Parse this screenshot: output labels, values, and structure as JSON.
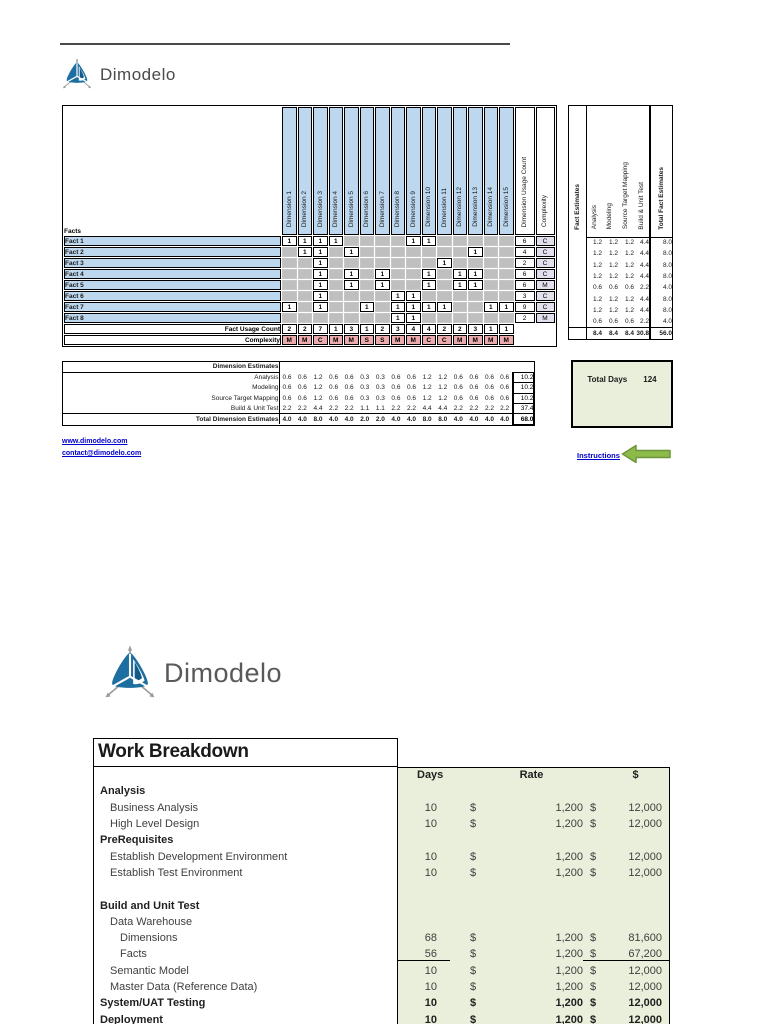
{
  "page1": {
    "brand": "Dimodelo",
    "matrix": {
      "facts_header": "Facts",
      "dimensions": [
        "Dimension 1",
        "Dimension 2",
        "Dimension 3",
        "Dimension 4",
        "Dimension 5",
        "Dimension 6",
        "Dimension 7",
        "Dimension 8",
        "Dimension 9",
        "Dimension 10",
        "Dimension 11",
        "Dimension 12",
        "Dimension 13",
        "Dimension 14",
        "Dimension 15"
      ],
      "usage_count_header": "Dimension Usage Count",
      "complexity_header": "Complexity",
      "facts": [
        {
          "label": "Fact 1",
          "cells": [
            "1",
            "1",
            "1",
            "1",
            "",
            "",
            "",
            "",
            "1",
            "1",
            "",
            "",
            "",
            "",
            ""
          ],
          "usage": "6",
          "complexity": "C"
        },
        {
          "label": "Fact 2",
          "cells": [
            "",
            "1",
            "1",
            "",
            "1",
            "",
            "",
            "",
            "",
            "",
            "",
            "",
            "1",
            "",
            ""
          ],
          "usage": "4",
          "complexity": "C"
        },
        {
          "label": "Fact 3",
          "cells": [
            "",
            "",
            "1",
            "",
            "",
            "",
            "",
            "",
            "",
            "",
            "1",
            "",
            "",
            "",
            ""
          ],
          "usage": "2",
          "complexity": "C"
        },
        {
          "label": "Fact 4",
          "cells": [
            "",
            "",
            "1",
            "",
            "1",
            "",
            "1",
            "",
            "",
            "1",
            "",
            "1",
            "1",
            "",
            ""
          ],
          "usage": "6",
          "complexity": "C"
        },
        {
          "label": "Fact 5",
          "cells": [
            "",
            "",
            "1",
            "",
            "1",
            "",
            "1",
            "",
            "",
            "1",
            "",
            "1",
            "1",
            "",
            ""
          ],
          "usage": "6",
          "complexity": "M"
        },
        {
          "label": "Fact 6",
          "cells": [
            "",
            "",
            "1",
            "",
            "",
            "",
            "",
            "1",
            "1",
            "",
            "",
            "",
            "",
            "",
            ""
          ],
          "usage": "3",
          "complexity": "C"
        },
        {
          "label": "Fact 7",
          "cells": [
            "1",
            "",
            "1",
            "",
            "",
            "1",
            "",
            "1",
            "1",
            "1",
            "1",
            "",
            "",
            "1",
            "1"
          ],
          "usage": "9",
          "complexity": "C"
        },
        {
          "label": "Fact 8",
          "cells": [
            "",
            "",
            "",
            "",
            "",
            "",
            "",
            "1",
            "1",
            "",
            "",
            "",
            "",
            "",
            ""
          ],
          "usage": "2",
          "complexity": "M"
        }
      ],
      "fact_usage_label": "Fact Usage Count",
      "fact_usage_counts": [
        "2",
        "2",
        "7",
        "1",
        "3",
        "1",
        "2",
        "3",
        "4",
        "4",
        "2",
        "2",
        "3",
        "1",
        "1"
      ],
      "complexity_label": "Complexity",
      "dimension_complexity": [
        "M",
        "M",
        "C",
        "M",
        "M",
        "S",
        "S",
        "M",
        "M",
        "C",
        "C",
        "M",
        "M",
        "M",
        "M"
      ]
    },
    "fact_estimates": {
      "header": "Fact Estimates",
      "columns": [
        "Analysis",
        "Modeling",
        "Source Target Mapping",
        "Build & Unit Test"
      ],
      "total_header": "Total Fact Estimates",
      "rows": [
        [
          "1.2",
          "1.2",
          "1.2",
          "4.4",
          "8.0"
        ],
        [
          "1.2",
          "1.2",
          "1.2",
          "4.4",
          "8.0"
        ],
        [
          "1.2",
          "1.2",
          "1.2",
          "4.4",
          "8.0"
        ],
        [
          "1.2",
          "1.2",
          "1.2",
          "4.4",
          "8.0"
        ],
        [
          "0.6",
          "0.6",
          "0.6",
          "2.2",
          "4.0"
        ],
        [
          "1.2",
          "1.2",
          "1.2",
          "4.4",
          "8.0"
        ],
        [
          "1.2",
          "1.2",
          "1.2",
          "4.4",
          "8.0"
        ],
        [
          "0.6",
          "0.6",
          "0.6",
          "2.2",
          "4.0"
        ]
      ],
      "totals": [
        "8.4",
        "8.4",
        "8.4",
        "30.8",
        "56.0"
      ]
    },
    "dimension_estimates": {
      "header": "Dimension Estimates",
      "rows": [
        {
          "label": "Analysis",
          "values": [
            "0.6",
            "0.6",
            "1.2",
            "0.6",
            "0.6",
            "0.3",
            "0.3",
            "0.6",
            "0.6",
            "1.2",
            "1.2",
            "0.6",
            "0.6",
            "0.6",
            "0.6"
          ],
          "total": "10.2"
        },
        {
          "label": "Modeling",
          "values": [
            "0.6",
            "0.6",
            "1.2",
            "0.6",
            "0.6",
            "0.3",
            "0.3",
            "0.6",
            "0.6",
            "1.2",
            "1.2",
            "0.6",
            "0.6",
            "0.6",
            "0.6"
          ],
          "total": "10.2"
        },
        {
          "label": "Source Target Mapping",
          "values": [
            "0.6",
            "0.6",
            "1.2",
            "0.6",
            "0.6",
            "0.3",
            "0.3",
            "0.6",
            "0.6",
            "1.2",
            "1.2",
            "0.6",
            "0.6",
            "0.6",
            "0.6"
          ],
          "total": "10.2"
        },
        {
          "label": "Build & Unit Test",
          "values": [
            "2.2",
            "2.2",
            "4.4",
            "2.2",
            "2.2",
            "1.1",
            "1.1",
            "2.2",
            "2.2",
            "4.4",
            "4.4",
            "2.2",
            "2.2",
            "2.2",
            "2.2"
          ],
          "total": "37.4"
        },
        {
          "label": "Total Dimension Estimates",
          "values": [
            "4.0",
            "4.0",
            "8.0",
            "4.0",
            "4.0",
            "2.0",
            "2.0",
            "4.0",
            "4.0",
            "8.0",
            "8.0",
            "4.0",
            "4.0",
            "4.0",
            "4.0"
          ],
          "total": "68.0"
        }
      ]
    },
    "total_days": {
      "label": "Total Days",
      "value": "124"
    },
    "links": {
      "website": "www.dimodelo.com",
      "email": "contact@dimodelo.com"
    },
    "instructions": "Instructions",
    "colors": {
      "cell_blue": "#bdd7ee",
      "cell_gray": "#bfbfbf",
      "complexity_lavender": "#e4dfec",
      "complexity_pink": "#ecabad",
      "panel_green": "#e9efdb",
      "link_blue": "#0000cc",
      "arrow_green": "#8dbb4a"
    }
  },
  "page2": {
    "brand": "Dimodelo",
    "work_breakdown": {
      "title": "Work Breakdown",
      "columns": {
        "days": "Days",
        "rate": "Rate",
        "amount": "$"
      },
      "rows": [
        {
          "label": "Analysis",
          "level": 0,
          "bold": true,
          "days": "",
          "cur1": "",
          "rate": "",
          "cur2": "",
          "amount": ""
        },
        {
          "label": "Business Analysis",
          "level": 1,
          "bold": false,
          "days": "10",
          "cur1": "$",
          "rate": "1,200",
          "cur2": "$",
          "amount": "12,000"
        },
        {
          "label": "High Level Design",
          "level": 1,
          "bold": false,
          "days": "10",
          "cur1": "$",
          "rate": "1,200",
          "cur2": "$",
          "amount": "12,000"
        },
        {
          "label": "PreRequisites",
          "level": 0,
          "bold": true,
          "days": "",
          "cur1": "",
          "rate": "",
          "cur2": "",
          "amount": ""
        },
        {
          "label": "Establish Development Environment",
          "level": 1,
          "bold": false,
          "days": "10",
          "cur1": "$",
          "rate": "1,200",
          "cur2": "$",
          "amount": "12,000"
        },
        {
          "label": "Establish Test Environment",
          "level": 1,
          "bold": false,
          "days": "10",
          "cur1": "$",
          "rate": "1,200",
          "cur2": "$",
          "amount": "12,000"
        },
        {
          "label": "",
          "level": 0,
          "bold": false,
          "days": "",
          "cur1": "",
          "rate": "",
          "cur2": "",
          "amount": ""
        },
        {
          "label": "Build and Unit Test",
          "level": 0,
          "bold": true,
          "days": "",
          "cur1": "",
          "rate": "",
          "cur2": "",
          "amount": ""
        },
        {
          "label": "Data Warehouse",
          "level": 1,
          "bold": false,
          "days": "",
          "cur1": "",
          "rate": "",
          "cur2": "",
          "amount": ""
        },
        {
          "label": "Dimensions",
          "level": 2,
          "bold": false,
          "days": "68",
          "cur1": "$",
          "rate": "1,200",
          "cur2": "$",
          "amount": "81,600"
        },
        {
          "label": "Facts",
          "level": 2,
          "bold": false,
          "days": "56",
          "cur1": "$",
          "rate": "1,200",
          "cur2": "$",
          "amount": "67,200",
          "underline": true
        },
        {
          "label": "Semantic Model",
          "level": 1,
          "bold": false,
          "days": "10",
          "cur1": "$",
          "rate": "1,200",
          "cur2": "$",
          "amount": "12,000"
        },
        {
          "label": "Master Data (Reference Data)",
          "level": 1,
          "bold": false,
          "days": "10",
          "cur1": "$",
          "rate": "1,200",
          "cur2": "$",
          "amount": "12,000"
        },
        {
          "label": "System/UAT Testing",
          "level": 0,
          "bold": true,
          "days": "10",
          "cur1": "$",
          "rate": "1,200",
          "cur2": "$",
          "amount": "12,000"
        },
        {
          "label": "Deployment",
          "level": 0,
          "bold": true,
          "days": "10",
          "cur1": "$",
          "rate": "1,200",
          "cur2": "$",
          "amount": "12,000"
        }
      ]
    }
  }
}
